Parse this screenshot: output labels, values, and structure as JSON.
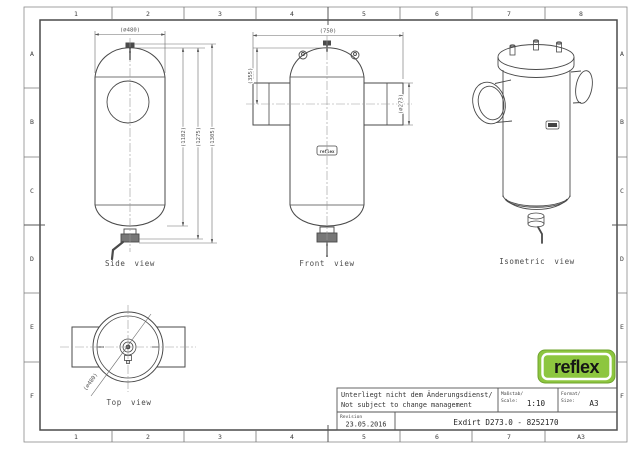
{
  "sheet": {
    "grid": {
      "top": [
        "1",
        "2",
        "3",
        "4",
        "5",
        "6",
        "7",
        "8"
      ],
      "bottom": [
        "1",
        "2",
        "3",
        "4",
        "5",
        "6",
        "7",
        "A3"
      ],
      "left": [
        "A",
        "B",
        "C",
        "D",
        "E",
        "F"
      ],
      "right": [
        "A",
        "B",
        "C",
        "D",
        "E",
        "F"
      ]
    },
    "views": {
      "side": {
        "label": "Side view",
        "dims": {
          "diameter": "(⌀480)",
          "h1": "(1182)",
          "h2": "(1275)",
          "h3": "(1305)"
        }
      },
      "front": {
        "label": "Front view",
        "dims": {
          "width": "(750)",
          "height_top": "(355)",
          "nozzle_diameter": "(⌀273)"
        }
      },
      "isometric": {
        "label": "Isometric view"
      },
      "top": {
        "label": "Top view",
        "dims": {
          "diameter": "(⌀480)"
        }
      }
    },
    "title_block": {
      "note_line1": "Unterliegt nicht dem Änderungsdienst/",
      "note_line2": "Not subject to change management",
      "scale_label_line1": "Maßstab/",
      "scale_label_line2": "Scale:",
      "scale_value": "1:10",
      "format_label_line1": "Format/",
      "format_label_line2": "Size:",
      "format_value": "A3",
      "revision_label": "Revision",
      "revision_value": "23.05.2016",
      "part_title": "Exdirt D273.0 - 8252170"
    },
    "logo": {
      "text": "reflex",
      "color": "#8dc63f"
    }
  }
}
